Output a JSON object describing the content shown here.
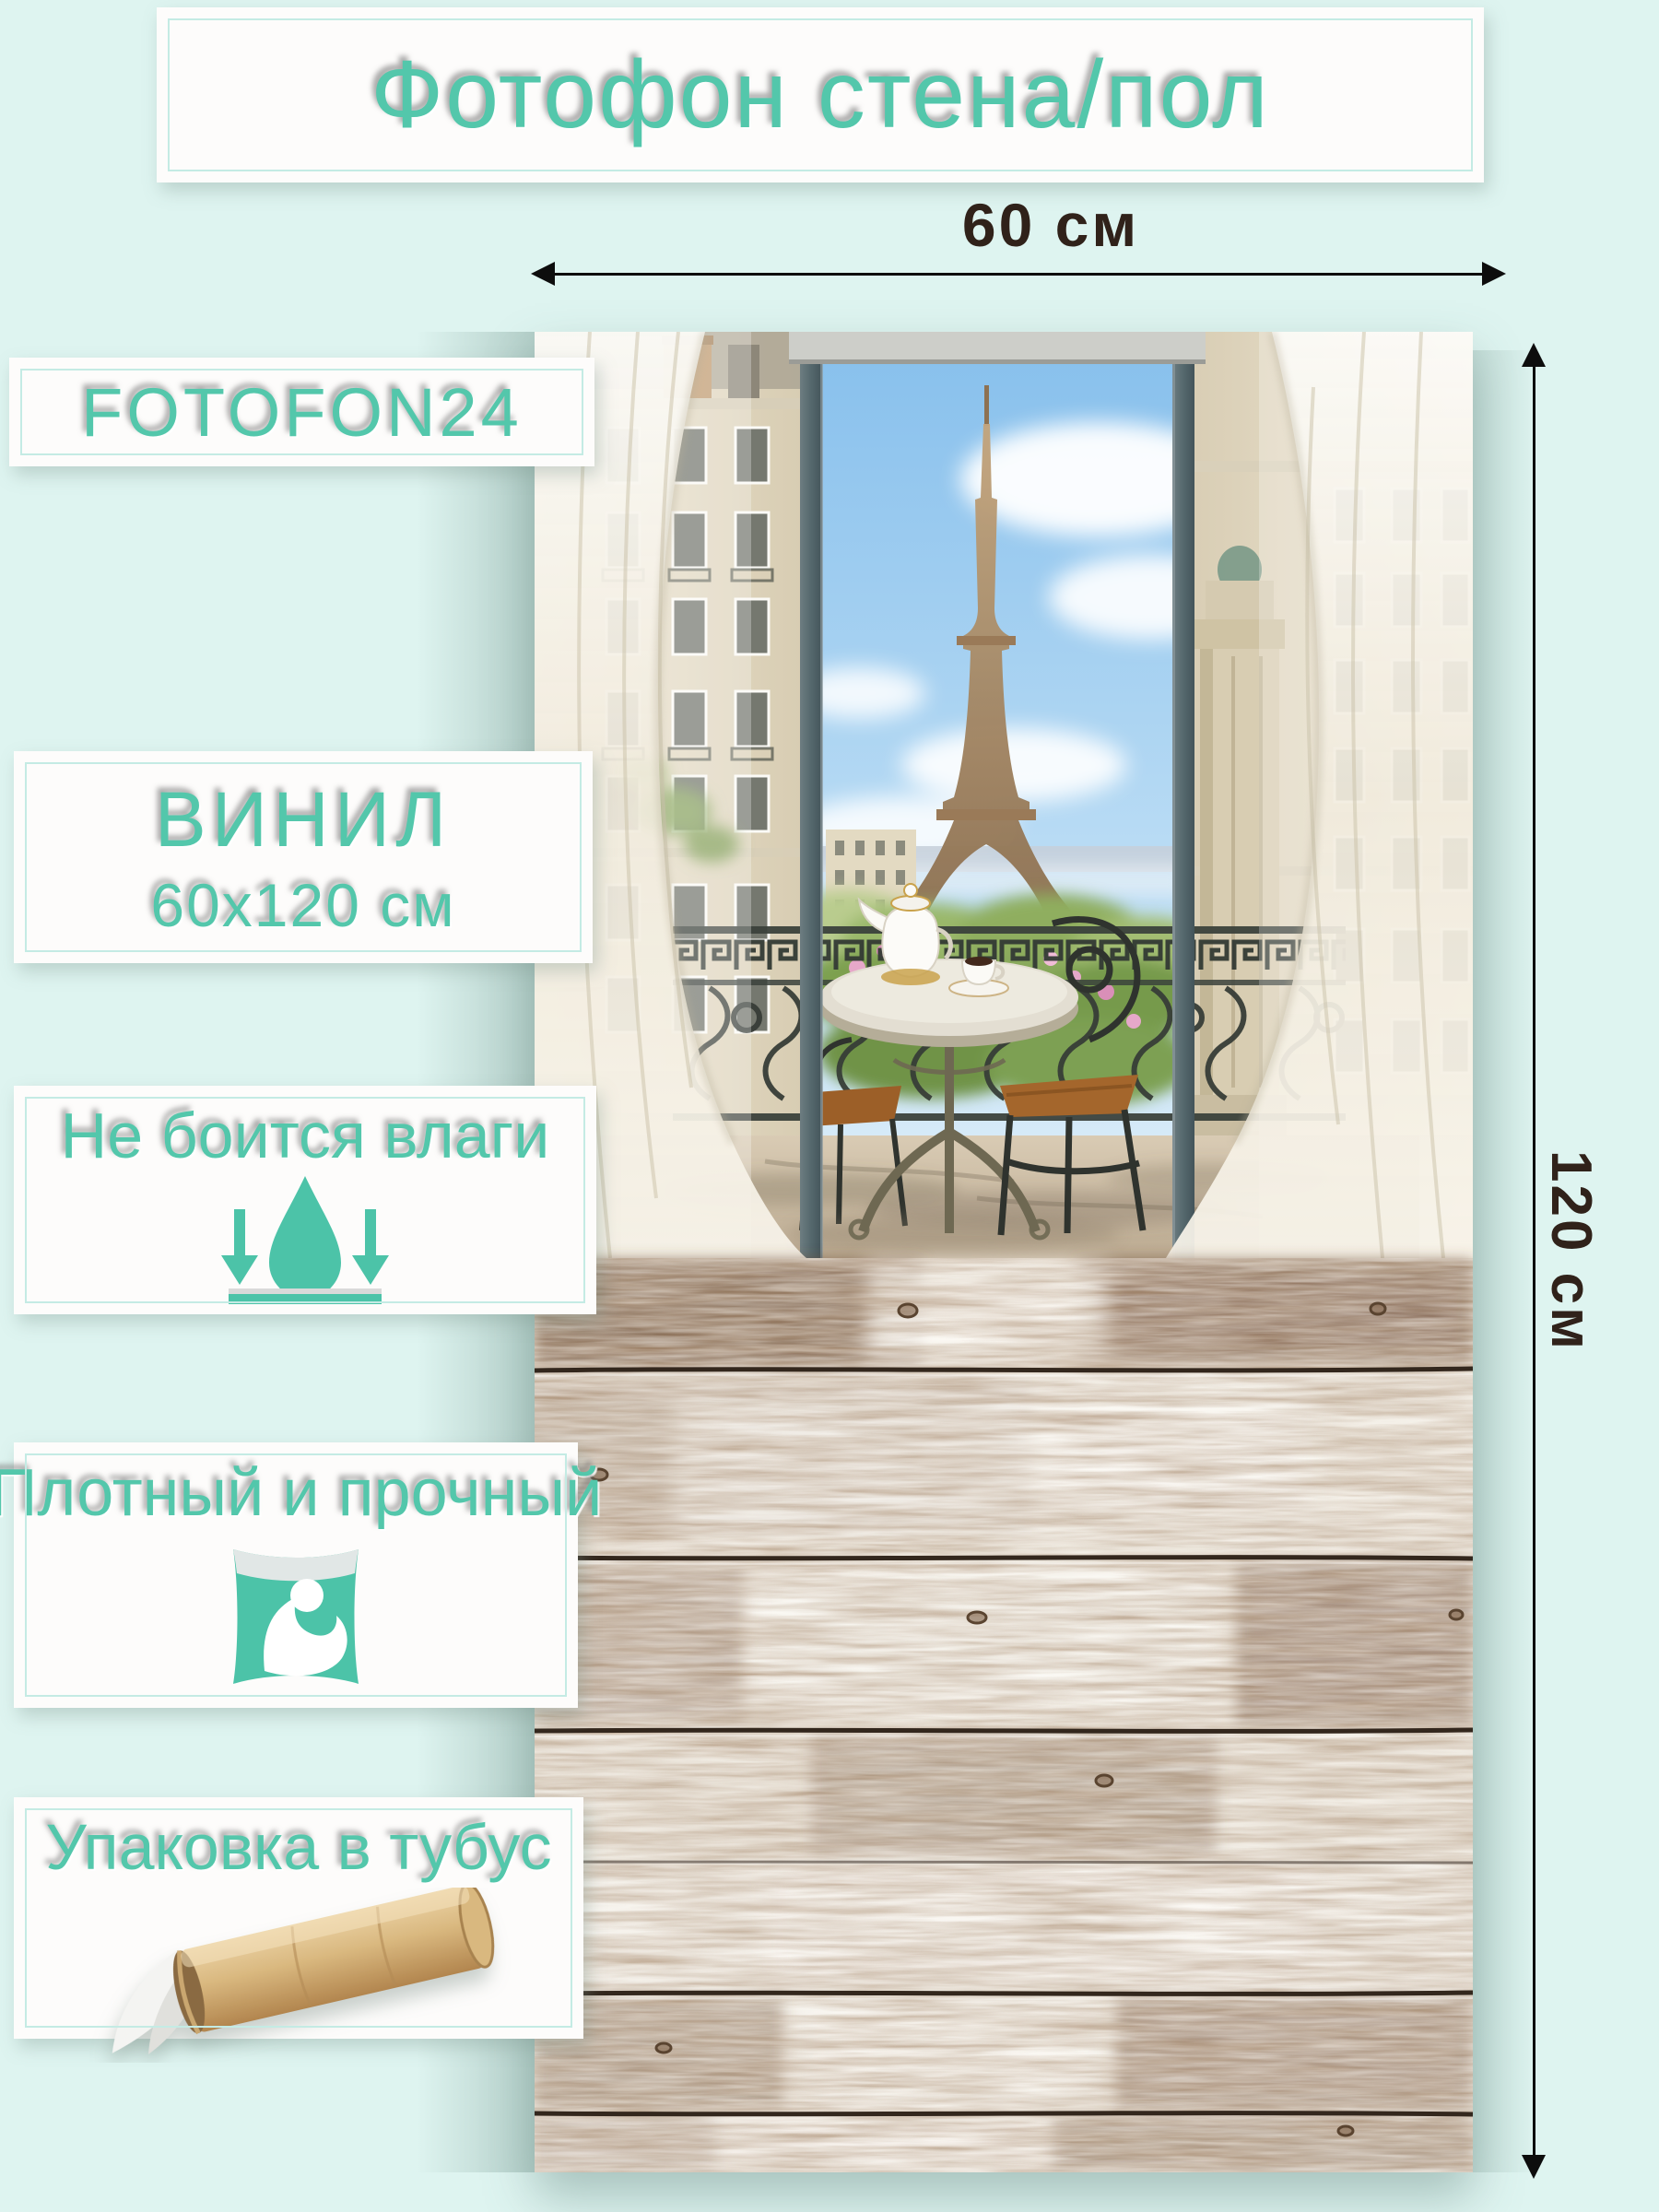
{
  "banner": {
    "title": "Фотофон стена/пол"
  },
  "brand": {
    "label": "FOTOFON24"
  },
  "dims": {
    "width_label": "60 см",
    "height_label": "120 см"
  },
  "material": {
    "line1": "ВИНИЛ",
    "line2": "60х120 см"
  },
  "feature_moisture": {
    "label": "Не боится влаги",
    "icon": "water-drop-arrows-icon"
  },
  "feature_durable": {
    "label": "Плотный и прочный",
    "icon": "strength-pillow-icon"
  },
  "feature_tube": {
    "label": "Упаковка в тубус",
    "icon": "cardboard-tube-icon"
  },
  "colors": {
    "accent_teal": "#53C7AB",
    "background": "#DEF4F0",
    "box_white": "#FDFCFB",
    "box_inner_border": "#C4EBE4",
    "dimension_text": "#30221A",
    "window_frame_slate": "#55686D",
    "wood_seam": "#33271D"
  }
}
